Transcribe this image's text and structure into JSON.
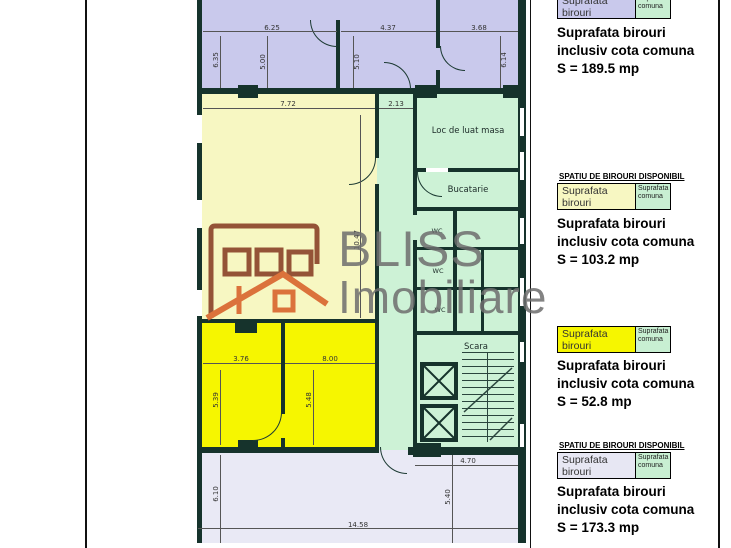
{
  "legend": {
    "available_heading": "SPATIU DE BIROURI DISPONIBIL",
    "box_office_label_1": "Suprafata",
    "box_office_label_2": "birouri",
    "box_common_label_1": "Suprafata",
    "box_common_label_2": "comuna",
    "sections": [
      {
        "line1": "Suprafata birouri",
        "line2": "inclusiv cota comuna",
        "area": "S = 189.5 mp",
        "color": "#c9c9ec"
      },
      {
        "line1": "Suprafata birouri",
        "line2": "inclusiv cota comuna",
        "area": "S = 103.2 mp",
        "color": "#f7f7c2"
      },
      {
        "line1": "Suprafata birouri",
        "line2": "inclusiv cota comuna",
        "area": "S = 52.8 mp",
        "color": "#f6f600"
      },
      {
        "line1": "Suprafata birouri",
        "line2": "inclusiv cota comuna",
        "area": "S = 173.3 mp",
        "color": "#e7e7f3"
      }
    ]
  },
  "plan": {
    "rooms": {
      "dining": "Loc de luat masa",
      "kitchen": "Bucatarie",
      "wc": "WC",
      "stairs": "Scara"
    },
    "dims": {
      "top1": "6.25",
      "top2": "4.37",
      "top3": "3.68",
      "v635": "6.35",
      "v500": "5.00",
      "v510": "5.10",
      "v614": "6.14",
      "w772": "7.72",
      "w213": "2.13",
      "v1047": "10.47",
      "w376": "3.76",
      "w800": "8.00",
      "v539": "5.39",
      "v548": "5.48",
      "w470": "4.70",
      "v540": "5.40",
      "v610": "6.10",
      "w1458": "14.58"
    },
    "region_colors": {
      "purple": "#c9c9ec",
      "pale_yellow": "#f7f7c2",
      "green": "#cdf2d6",
      "bright_yellow": "#f6f600",
      "lavender": "#e9e9f5",
      "wall": "#16332c"
    }
  },
  "watermark": {
    "line1": "BLISS",
    "line2": "Imobiliare"
  }
}
